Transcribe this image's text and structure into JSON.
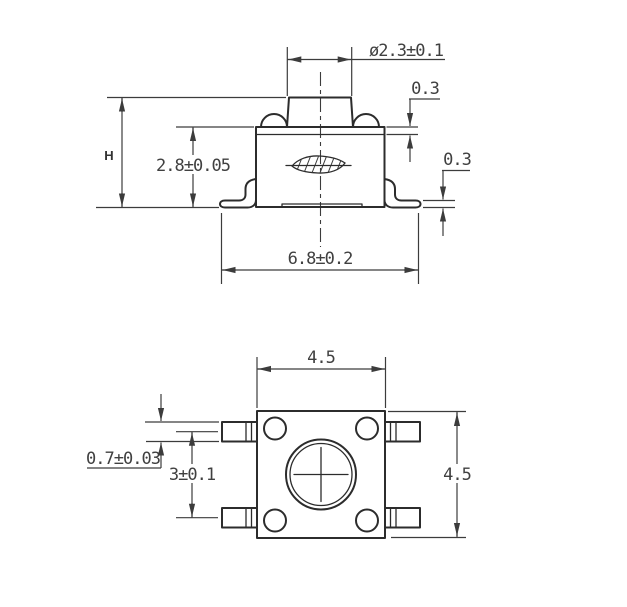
{
  "drawing_type": "tactile-switch-dimension-drawing",
  "colors": {
    "background": "#ffffff",
    "object_line": "#2c2c2c",
    "dimension_line": "#3c3c3c",
    "text": "#404040"
  },
  "side_view": {
    "dim_plunger_diameter": "ø2.3±0.1",
    "dim_cover_thickness": "0.3",
    "dim_terminal_thickness": "0.3",
    "dim_overall_height": "H",
    "dim_body_height": "2.8±0.05",
    "dim_overall_width": "6.8±0.2"
  },
  "top_view": {
    "dim_body_width": "4.5",
    "dim_body_depth": "4.5",
    "dim_lead_pitch": "3±0.1",
    "dim_lead_width": "0.7±0.03"
  }
}
